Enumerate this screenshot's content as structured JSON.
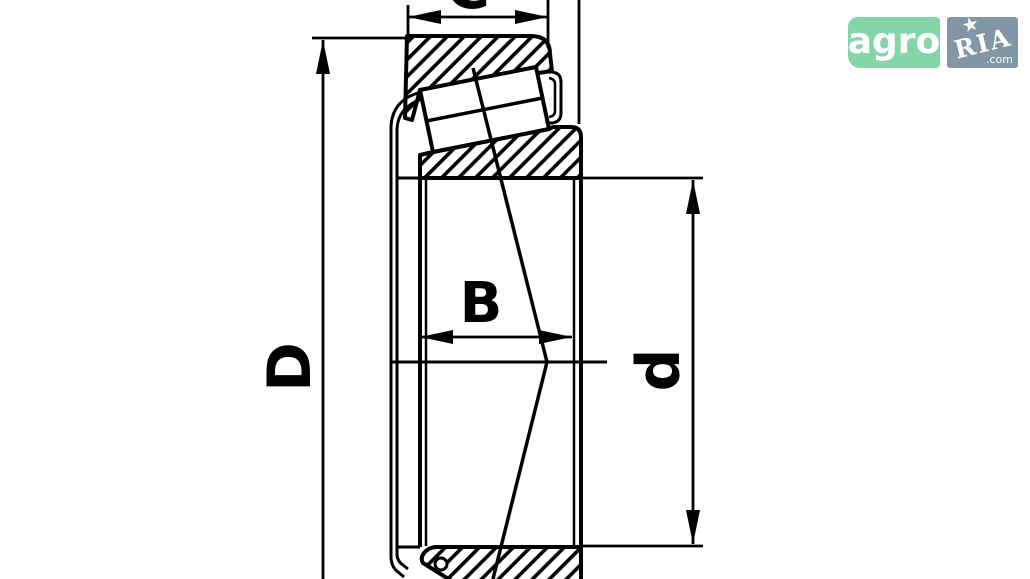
{
  "title": "Tapered roller bearing dimensional cross-section drawing",
  "dimensions": {
    "outer_diameter_label": "D",
    "bore_diameter_label": "d",
    "cone_width_label": "B",
    "cup_width_label": "C"
  },
  "logo": {
    "left_text": "agro",
    "right_text": "RIA",
    "right_suffix": ".com",
    "star_glyph": "★",
    "left_bg": "#84d5a8",
    "right_bg": "#8197a6",
    "text_color": "#ffffff"
  },
  "drawing": {
    "stroke_color": "#000000",
    "background": "#ffffff"
  }
}
